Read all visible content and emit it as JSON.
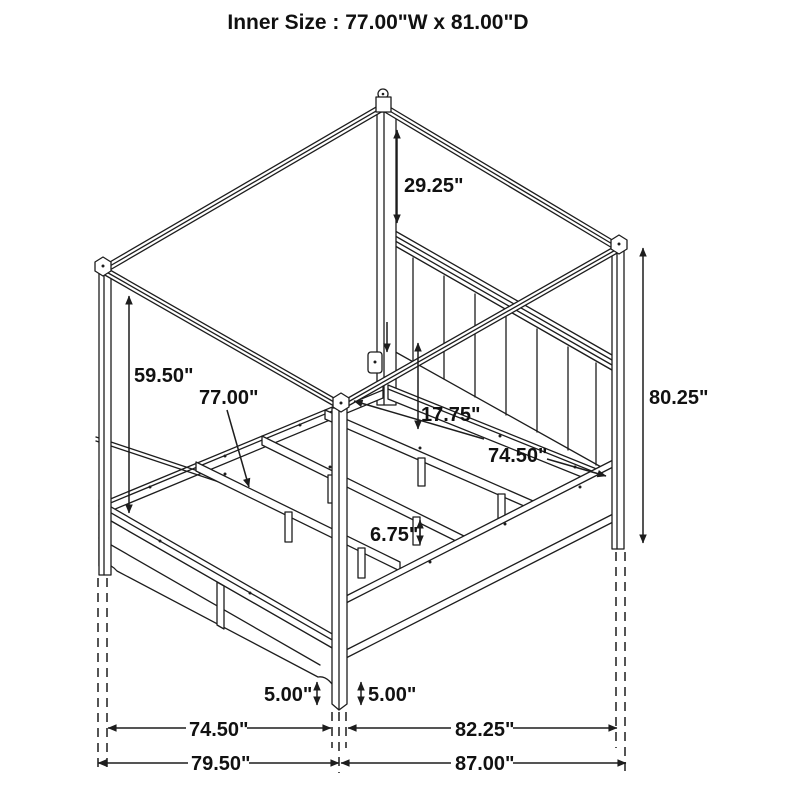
{
  "header": {
    "title": "Inner Size : 77.00\"W x 81.00\"D"
  },
  "diagram": {
    "type": "furniture-dimension-line-drawing",
    "subject": "four-poster canopy bed, isometric view",
    "dimensions": {
      "canopy_to_headboard": "29.25\"",
      "post_upper_height": "59.50\"",
      "inner_slat_width": "77.00\"",
      "headboard_to_rail": "17.75\"",
      "side_rail_length": "74.50\"",
      "overall_height": "80.25\"",
      "slat_leg_height": "6.75\"",
      "footboard_floor_clearance": "5.00\"",
      "rail_floor_clearance": "5.00\"",
      "front_width_inner": "74.50\"",
      "front_width_overall": "79.50\"",
      "side_depth_inner": "82.25\"",
      "side_depth_overall": "87.00\""
    }
  }
}
